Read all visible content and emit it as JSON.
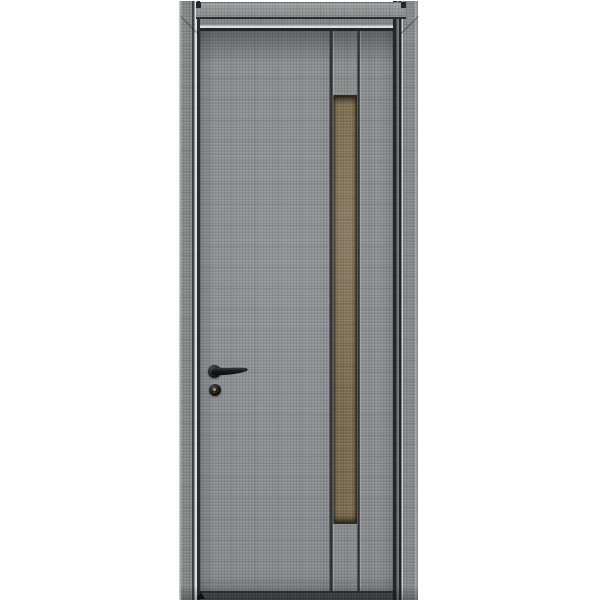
{
  "scene": {
    "type": "product-photo",
    "description": "Product photograph of a gray linen-textured interior door in a matching gray frame, with a full-height vertical bronze-brown inlay strip between two grooves on the right half, a black lever handle with round rosette and round keyhole escutcheon on the left stile, on a plain white background"
  },
  "colors": {
    "bg": "#ffffff",
    "door_gray": "#8b8e90",
    "frame_gray": "#858889",
    "header_gray": "#8f9293",
    "inlay_brown": "#7b6a4c",
    "groove_dark": "#33363a",
    "edge_dark": "#212426",
    "highlight": "#dcdedf",
    "handle_black": "#141517",
    "key_gold": "#b98e3e",
    "threshold_dark": "#474a4c"
  },
  "parts": {
    "frame": [
      "left-jamb",
      "right-jamb",
      "header-board",
      "head-jamb"
    ],
    "door": [
      "door-leaf",
      "groove-left",
      "groove-right",
      "inlay-strip"
    ],
    "hardware": [
      "lever-handle",
      "handle-rosette",
      "keyhole-escutcheon",
      "keyhole"
    ],
    "floor": [
      "threshold-shadow",
      "floor-door-stop"
    ]
  }
}
